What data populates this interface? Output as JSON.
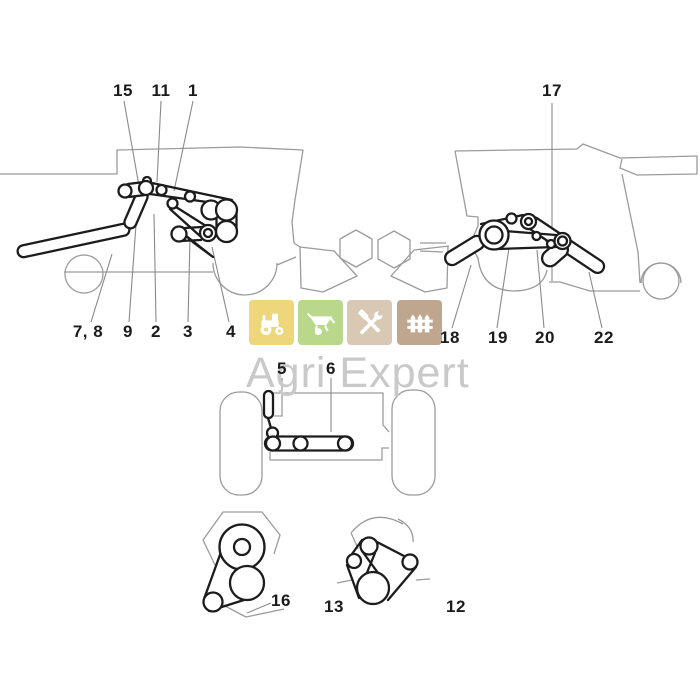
{
  "labels": [
    {
      "id": "15",
      "text": "15"
    },
    {
      "id": "11",
      "text": "11"
    },
    {
      "id": "1",
      "text": "1"
    },
    {
      "id": "17",
      "text": "17"
    },
    {
      "id": "7-8",
      "text": "7, 8"
    },
    {
      "id": "9",
      "text": "9"
    },
    {
      "id": "2",
      "text": "2"
    },
    {
      "id": "3",
      "text": "3"
    },
    {
      "id": "4",
      "text": "4"
    },
    {
      "id": "18",
      "text": "18"
    },
    {
      "id": "19",
      "text": "19"
    },
    {
      "id": "20",
      "text": "20"
    },
    {
      "id": "22",
      "text": "22"
    },
    {
      "id": "5",
      "text": "5"
    },
    {
      "id": "6",
      "text": "6"
    },
    {
      "id": "16",
      "text": "16"
    },
    {
      "id": "13",
      "text": "13"
    },
    {
      "id": "12",
      "text": "12"
    }
  ],
  "watermark": {
    "brand": "Agri Expert",
    "icons": [
      {
        "name": "tractor",
        "background": "#eed77a",
        "glyph_color": "#ffffff"
      },
      {
        "name": "wheelbarrow",
        "background": "#b9d88c",
        "glyph_color": "#ffffff"
      },
      {
        "name": "tools",
        "background": "#d9c8b4",
        "glyph_color": "#ffffff"
      },
      {
        "name": "fence",
        "background": "#bfa78f",
        "glyph_color": "#ffffff"
      }
    ]
  },
  "colors": {
    "background": "#ffffff",
    "diagram_dark_line": "#1c1c1c",
    "machine_outline_gray": "#9b9b9b",
    "leader_line_gray": "#8a8a8a",
    "label_text": "#1b1b1b",
    "watermark_text": "#c9c9c9"
  }
}
